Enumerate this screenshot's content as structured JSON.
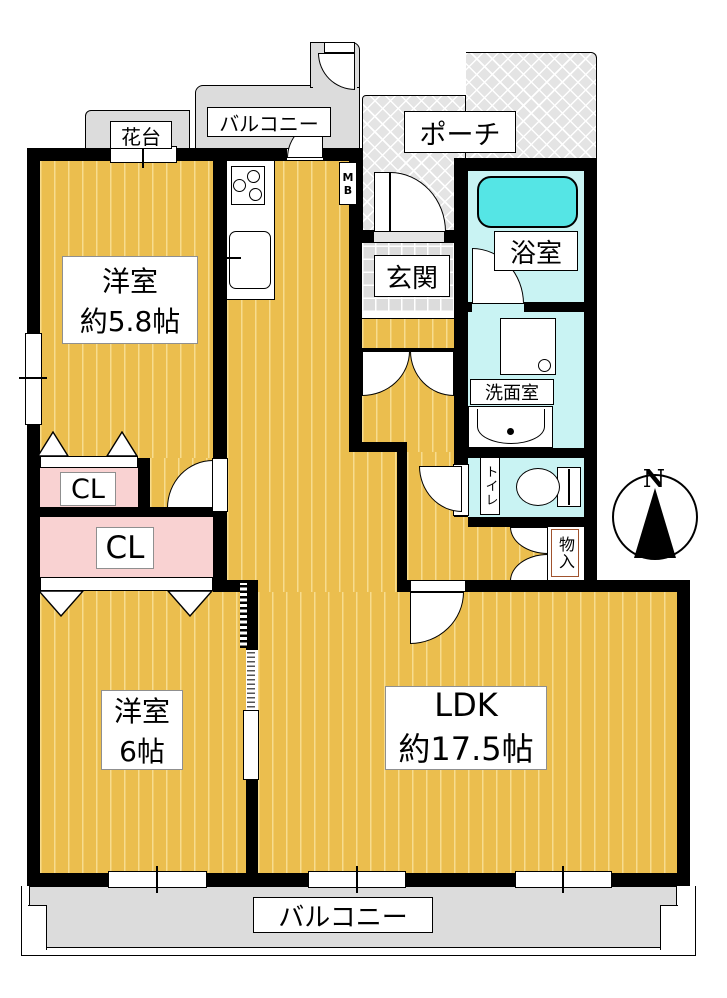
{
  "title": "Japanese apartment floor plan 2LDK",
  "colors": {
    "wall": "#000000",
    "wood_floor": "#EBBE4E",
    "wood_stripe": "#F7DC8E",
    "closet_pink": "#F9D2D2",
    "wet_area_cyan": "#C9F3F3",
    "bathtub_cyan": "#55E5E5",
    "balcony_gray": "#DCDCDC",
    "porch_gray": "#E4E4E4",
    "storage_label_border": "#A0522D"
  },
  "labels": {
    "balcony_top": "バルコニー",
    "flower_stand": "花台",
    "porch": "ポーチ",
    "meter_box": "MB",
    "entrance": "玄関",
    "bathroom": "浴室",
    "washroom": "洗面室",
    "toilet": "トイレ",
    "storage": "物入",
    "closet_small": "CL",
    "closet_large": "CL",
    "room1_line1": "洋室",
    "room1_line2": "約5.8帖",
    "room2_line1": "洋室",
    "room2_line2": "6帖",
    "ldk_line1": "LDK",
    "ldk_line2": "約17.5帖",
    "balcony_bottom": "バルコニー",
    "compass_north": "N"
  }
}
